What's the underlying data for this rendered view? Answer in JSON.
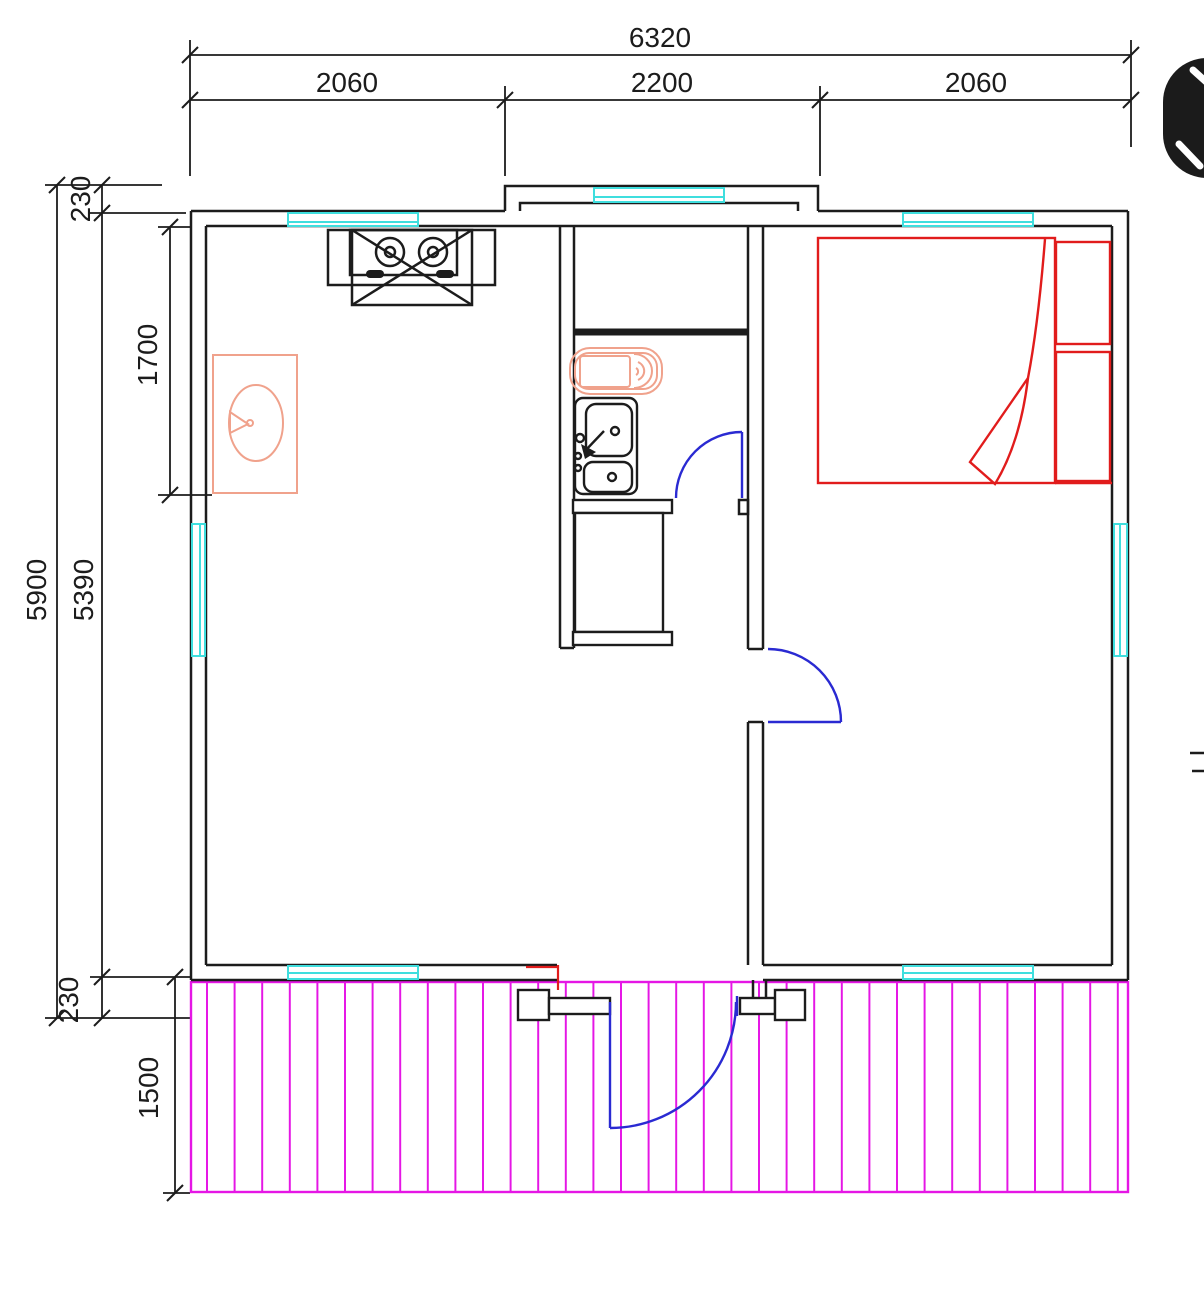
{
  "dimensions": {
    "top": {
      "total": "6320",
      "segments": [
        "2060",
        "2200",
        "2060"
      ]
    },
    "left": {
      "overall": "5900",
      "interior": "5390",
      "top_wall": "230",
      "kitchen_zone": "1700",
      "bottom_wall": "230",
      "deck_depth": "1500"
    }
  },
  "icons": {
    "corner": "expand-diagonal-icon"
  },
  "colors": {
    "line": "#1c1c1c",
    "window": "#3fdede",
    "bed": "#e11c1c",
    "fixture": "#f0a28c",
    "door": "#2a2ad2",
    "deck": "#e516e5",
    "icon_bg": "#1b1b1b"
  }
}
